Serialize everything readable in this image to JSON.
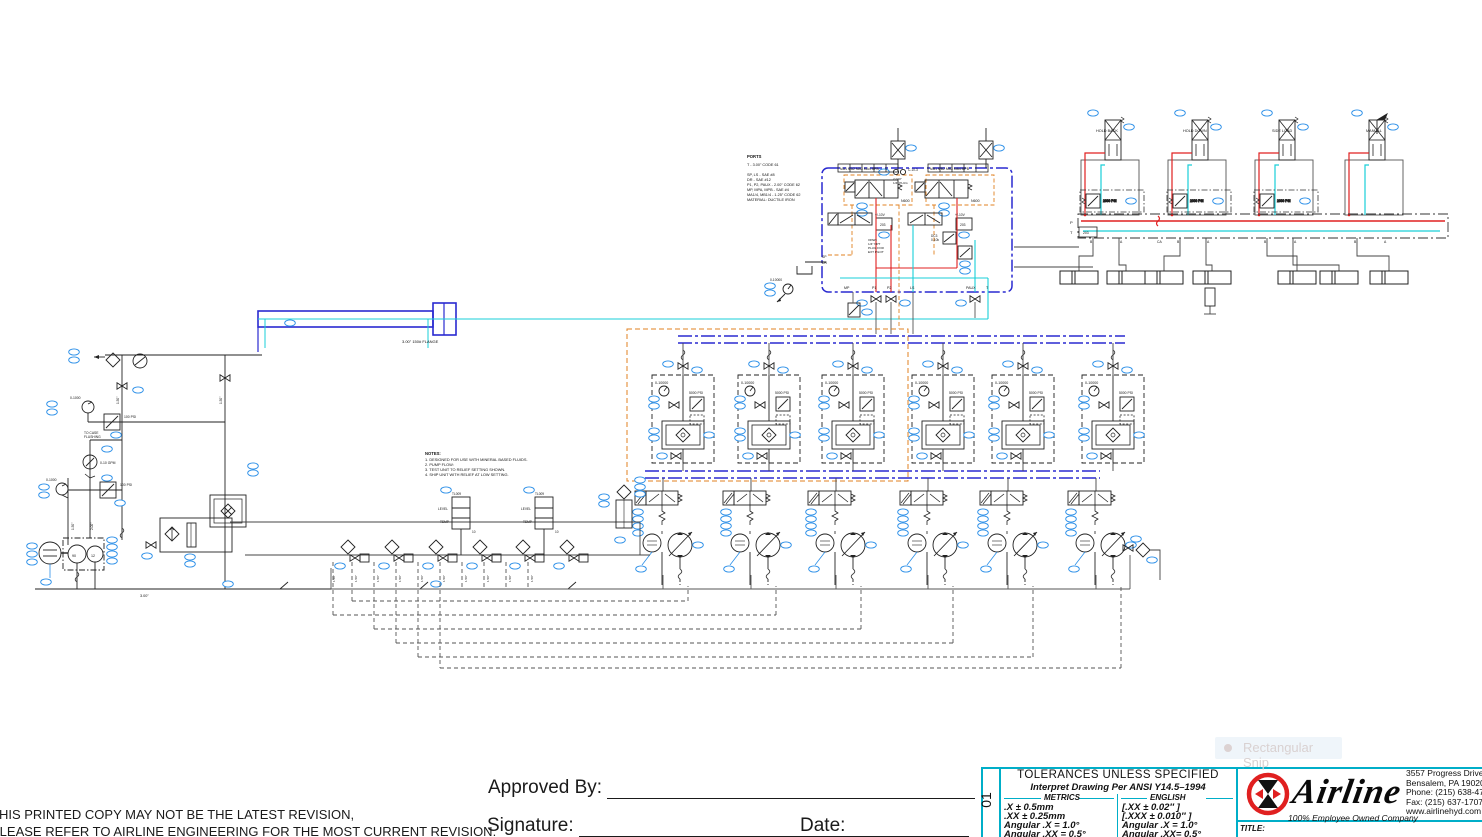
{
  "tooltip": {
    "text": "Rectangular Snip"
  },
  "footer": {
    "warning_line1": "THIS PRINTED COPY MAY NOT BE THE LATEST REVISION,",
    "warning_line2": "PLEASE REFER TO AIRLINE ENGINEERING FOR THE MOST CURRENT REVISION.",
    "approved_by_label": "Approved By:",
    "signature_label": "Signature:",
    "date_label": "Date:"
  },
  "title_block": {
    "sheet_code": "01",
    "tolerances_title": "TOLERANCES UNLESS SPECIFIED",
    "tolerances_subtitle": "Interpret  Drawing  Per  ANSI  Y14.5–1994",
    "metrics_header": "METRICS",
    "english_header": "ENGLISH",
    "metrics_rows": [
      ".X      ±  0.5mm",
      ".XX    ±  0.25mm",
      "Angular .X    =   1.0°",
      "Angular .XX  =   0.5°"
    ],
    "english_rows": [
      "[.XX  ±    0.02″ ]",
      "[.XXX ±  0.010″ ]",
      "Angular .X  =    1.0°",
      "Angular .XX=    0.5°"
    ],
    "company_name": "Airline",
    "tagline": "100% Employee Owned Company",
    "address_lines": [
      "3557 Progress Drive,",
      "Bensalem, PA  19020",
      "Phone: (215) 638-4700",
      "Fax: (215) 637-1707",
      "www.airlinehyd.com"
    ],
    "title_label": "TITLE:"
  },
  "sch": {
    "stations": [
      "HOLD BACK",
      "HOLD DOWN",
      "SIDE LOAD",
      "MANUAL"
    ],
    "ports_note": [
      "PORTS",
      "T - 3.00\" CODE 61",
      "SP, LS - SAE #8",
      "DR - SAE #12",
      "P1, P2, PAUX - 2.00\" CODE 62",
      "MP, MPA, MPB - SAE #4",
      "MA1/4, MB1/4 - 1.25\" CODE 62",
      "MATERIAL: DUCTILE IRON"
    ],
    "notes": [
      "NOTES:",
      "1. DESIGNED FOR USE WITH MINERAL BASED FLUIDS.",
      "2. PUMP FLOW:",
      "3. TEST UNIT TO RELIEF SETTING SHOWN.",
      "4. SHIP UNIT WITH RELIEF AT LOW SETTING."
    ],
    "flange": "3.00\" 150# FLANGE",
    "top_ports_a": "MA1  MA2  MA3  MA4  MPA",
    "top_ports_b": "MB1  MB2  MB3  MB4  MPB",
    "bottom_ports": [
      "MP",
      "P1",
      "P2",
      "LS",
      "PAUX",
      "T"
    ],
    "sp": "SP",
    "dr": "DR",
    "p": "P",
    "t": "T",
    "t_num": "203",
    "port_b": "B",
    "port_a": "A",
    "port_ca": "CA",
    "n600": "N600",
    "signal": "+/-10V",
    "amp": "203",
    "dc3": "DC3",
    "pot": "0-10k",
    "open1": "OPEN",
    "open2": "1/4\" NPT",
    "open3": "PLUG FOR",
    "open4": "EXT PILOT",
    "orifice": "C-10-3",
    "plug1": "2.040\"",
    "plug2": "1/4\" PLUG",
    "g10000": "0-10000",
    "g1000": "0-1000",
    "r100": "100 PSI",
    "r5000": "5000 PSI",
    "r2000": "2000 PSI",
    "flow": "0-10 GPM",
    "flush1": "TO CASE",
    "flush2": "FLUSHING",
    "level": "LEVEL",
    "temp": "TEMP",
    "tl": "TL009",
    "ten": "10",
    "p90": "90",
    "p12": "12",
    "pipe3": "3.00\"",
    "pipe15": "1.50\"",
    "pipe2": "2.00\""
  }
}
